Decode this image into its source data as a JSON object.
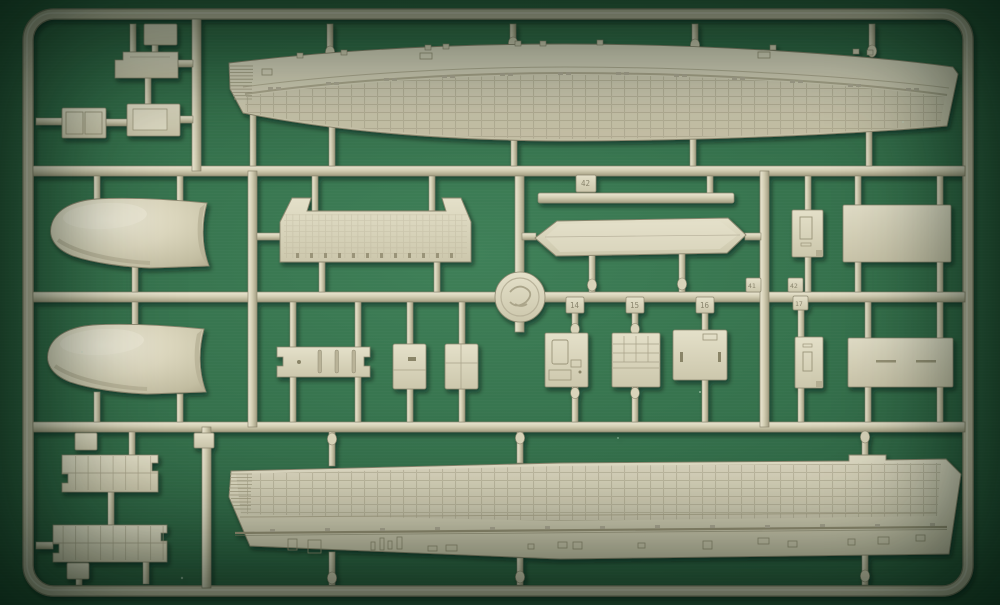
{
  "scene": {
    "type": "photograph",
    "subject": "Light tan injection-molded plastic model-kit sprue (parts tree) lying on a dark green cutting mat",
    "background": {
      "mat_green": "#35714c",
      "vignette": "#0a1f13"
    },
    "plastic": {
      "base": "#d4cfb4",
      "highlight": "#eae6d2",
      "shadow": "#a19c80",
      "outline": "#8d8870"
    }
  },
  "sprue": {
    "frame": "rounded rectangular outer runner frame with internal cross runners and sprue gates",
    "hub": "round molding hub with embossed maker's mark at center",
    "tags": [
      {
        "label": "42"
      },
      {
        "label": "14"
      },
      {
        "label": "15"
      },
      {
        "label": "16"
      },
      {
        "label": "41"
      },
      {
        "label": "42"
      },
      {
        "label": "17"
      }
    ],
    "parts": [
      {
        "name": "upper-hull-side",
        "description": "Long curved side wall with panel grid, detail band and tapered ribbed tip"
      },
      {
        "name": "lower-hull-side",
        "description": "Long side wall with dense panel grid, rail line and small fittings"
      },
      {
        "name": "nose-cowl-upper",
        "description": "Rounded nose/bow shell half"
      },
      {
        "name": "nose-cowl-lower",
        "description": "Rounded nose/bow shell half"
      },
      {
        "name": "gridded-deck-panel",
        "description": "Wide deck panel with fine grid and notched shoulders"
      },
      {
        "name": "thin-strip",
        "description": "Long thin strip"
      },
      {
        "name": "elongated-platform",
        "description": "Elongated platform with pointed ends"
      },
      {
        "name": "slotted-plate",
        "description": "Plate with three vertical slots and locating hole"
      },
      {
        "name": "hatch-plate-1",
        "description": "Small hatch plate with slot"
      },
      {
        "name": "hatch-plate-2",
        "description": "Small hatch plate with seam line"
      },
      {
        "name": "bulkhead-14",
        "description": "Detailed bulkhead panel, tag 14"
      },
      {
        "name": "bulkhead-15",
        "description": "Gridded bulkhead panel, tag 15"
      },
      {
        "name": "door-panel-16",
        "description": "Flat panel with two slots, tag 16"
      },
      {
        "name": "bracket-17",
        "description": "Tall bracket plate, tag 17"
      },
      {
        "name": "slitted-panel",
        "description": "Wide panel with two slits"
      },
      {
        "name": "fitting-panel",
        "description": "Small fitting panel with raised detail"
      },
      {
        "name": "large-flat-panel",
        "description": "Large plain rectangular panel"
      },
      {
        "name": "walkway-1",
        "description": "Ribbed walkway section with side notches"
      },
      {
        "name": "walkway-2",
        "description": "Ribbed walkway section with side notches"
      },
      {
        "name": "plate-a",
        "description": "Small stepped plate"
      },
      {
        "name": "plate-b",
        "description": "Double-door plate"
      },
      {
        "name": "plate-c",
        "description": "Plate with raised insert"
      },
      {
        "name": "top-plate",
        "description": "Small plate on top frame"
      },
      {
        "name": "tiny-clip-1",
        "description": "Tiny clip part"
      },
      {
        "name": "tiny-clip-2",
        "description": "Tiny clip part"
      },
      {
        "name": "corner-clip",
        "description": "Small corner part"
      }
    ]
  }
}
